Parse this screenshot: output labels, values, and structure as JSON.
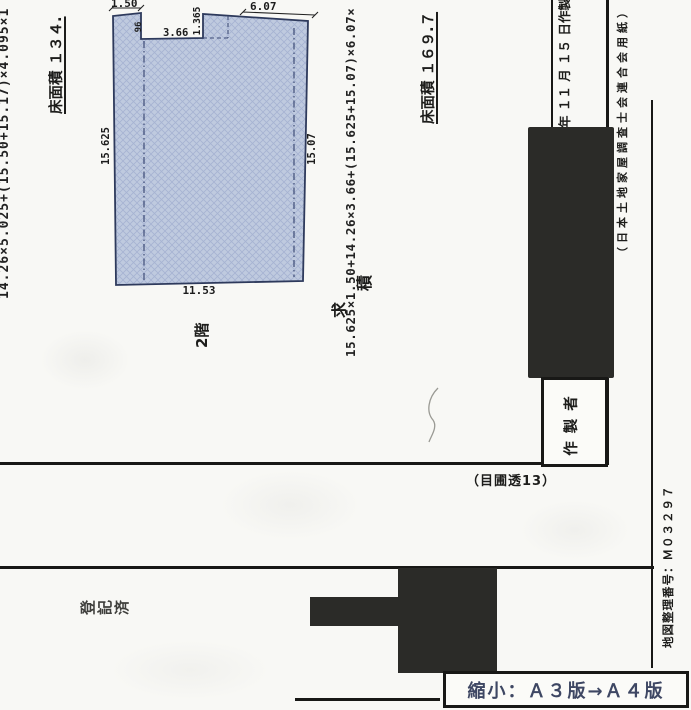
{
  "page": {
    "left_formula": "14.26×5.025+(15.50+15.17)×4.095×1",
    "left_area_label": "床面積 １３４.",
    "floor_label": "2階",
    "kyuseki": {
      "char1": "求",
      "char2": "積"
    },
    "center_formula": "15.625×1.50+14.26×3.66+(15.625+15.07)×6.07×",
    "right_area_label": "床面積 １６９.７",
    "date_note": "年 １１ 月 １５ 日作製",
    "paper_note": "（日本土地家屋調査士会連合会用紙）",
    "creator_label": "作製者",
    "frame_note": "（目圃透13）",
    "registry_stamp": {
      "char1": "登",
      "char2": "記",
      "char3": "済"
    },
    "map_number": "地図整理番号：Ｍ０３２９７",
    "reduction_note": "縮小：Ａ３版→Ａ４版"
  },
  "plan_dims": {
    "top_left": "1.50",
    "notch_depth": "96",
    "notch_width": "3.66",
    "step_height": "1.365",
    "top_right": "6.07",
    "left_side": "15.625",
    "right_side": "15.07",
    "bottom": "11.53"
  },
  "colors": {
    "plan_fill": "#bfcadf",
    "plan_hatch": "#a6b3d2",
    "plan_outline": "#2e3a5c",
    "ink": "#1d1d1b",
    "redaction": "#2b2b28",
    "stamp_blue": "#3e4763"
  }
}
